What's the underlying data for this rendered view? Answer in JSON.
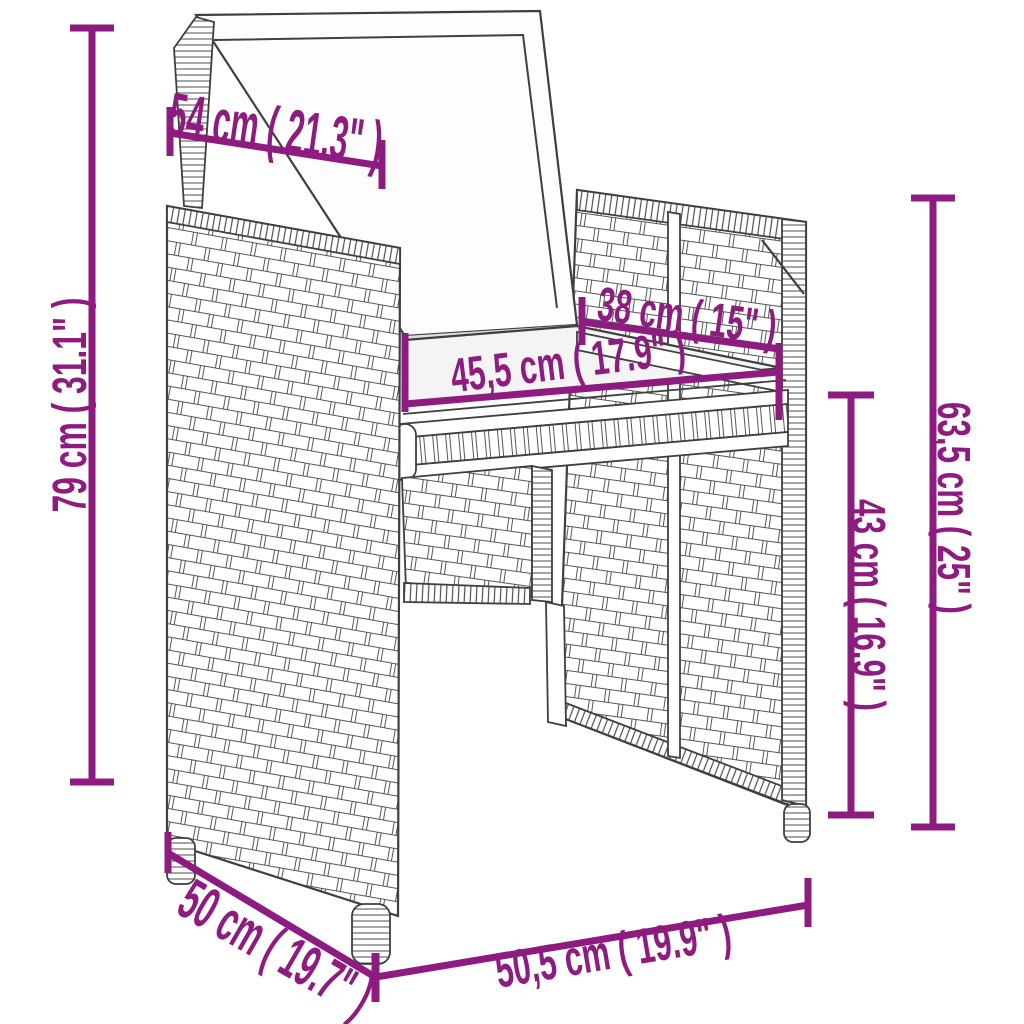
{
  "diagram": {
    "subject": "poly-rattan garden armchair with back and seat cushions",
    "accent_color": "#8e1c80",
    "artwork_line_color": "#3f3f3f",
    "dimensions": {
      "back_cushion_width": "54 cm ( 21.3\" )",
      "total_height": "79 cm ( 31.1\" )",
      "seat_depth": "38 cm ( 15\" )",
      "seat_width": "45,5 cm ( 17.9\" )",
      "backrest_height": "63,5 cm ( 25\" )",
      "seat_height": "43 cm ( 16.9\" )",
      "base_depth": "50 cm ( 19.7\" )",
      "base_width": "50,5 cm ( 19.9\" )"
    }
  }
}
